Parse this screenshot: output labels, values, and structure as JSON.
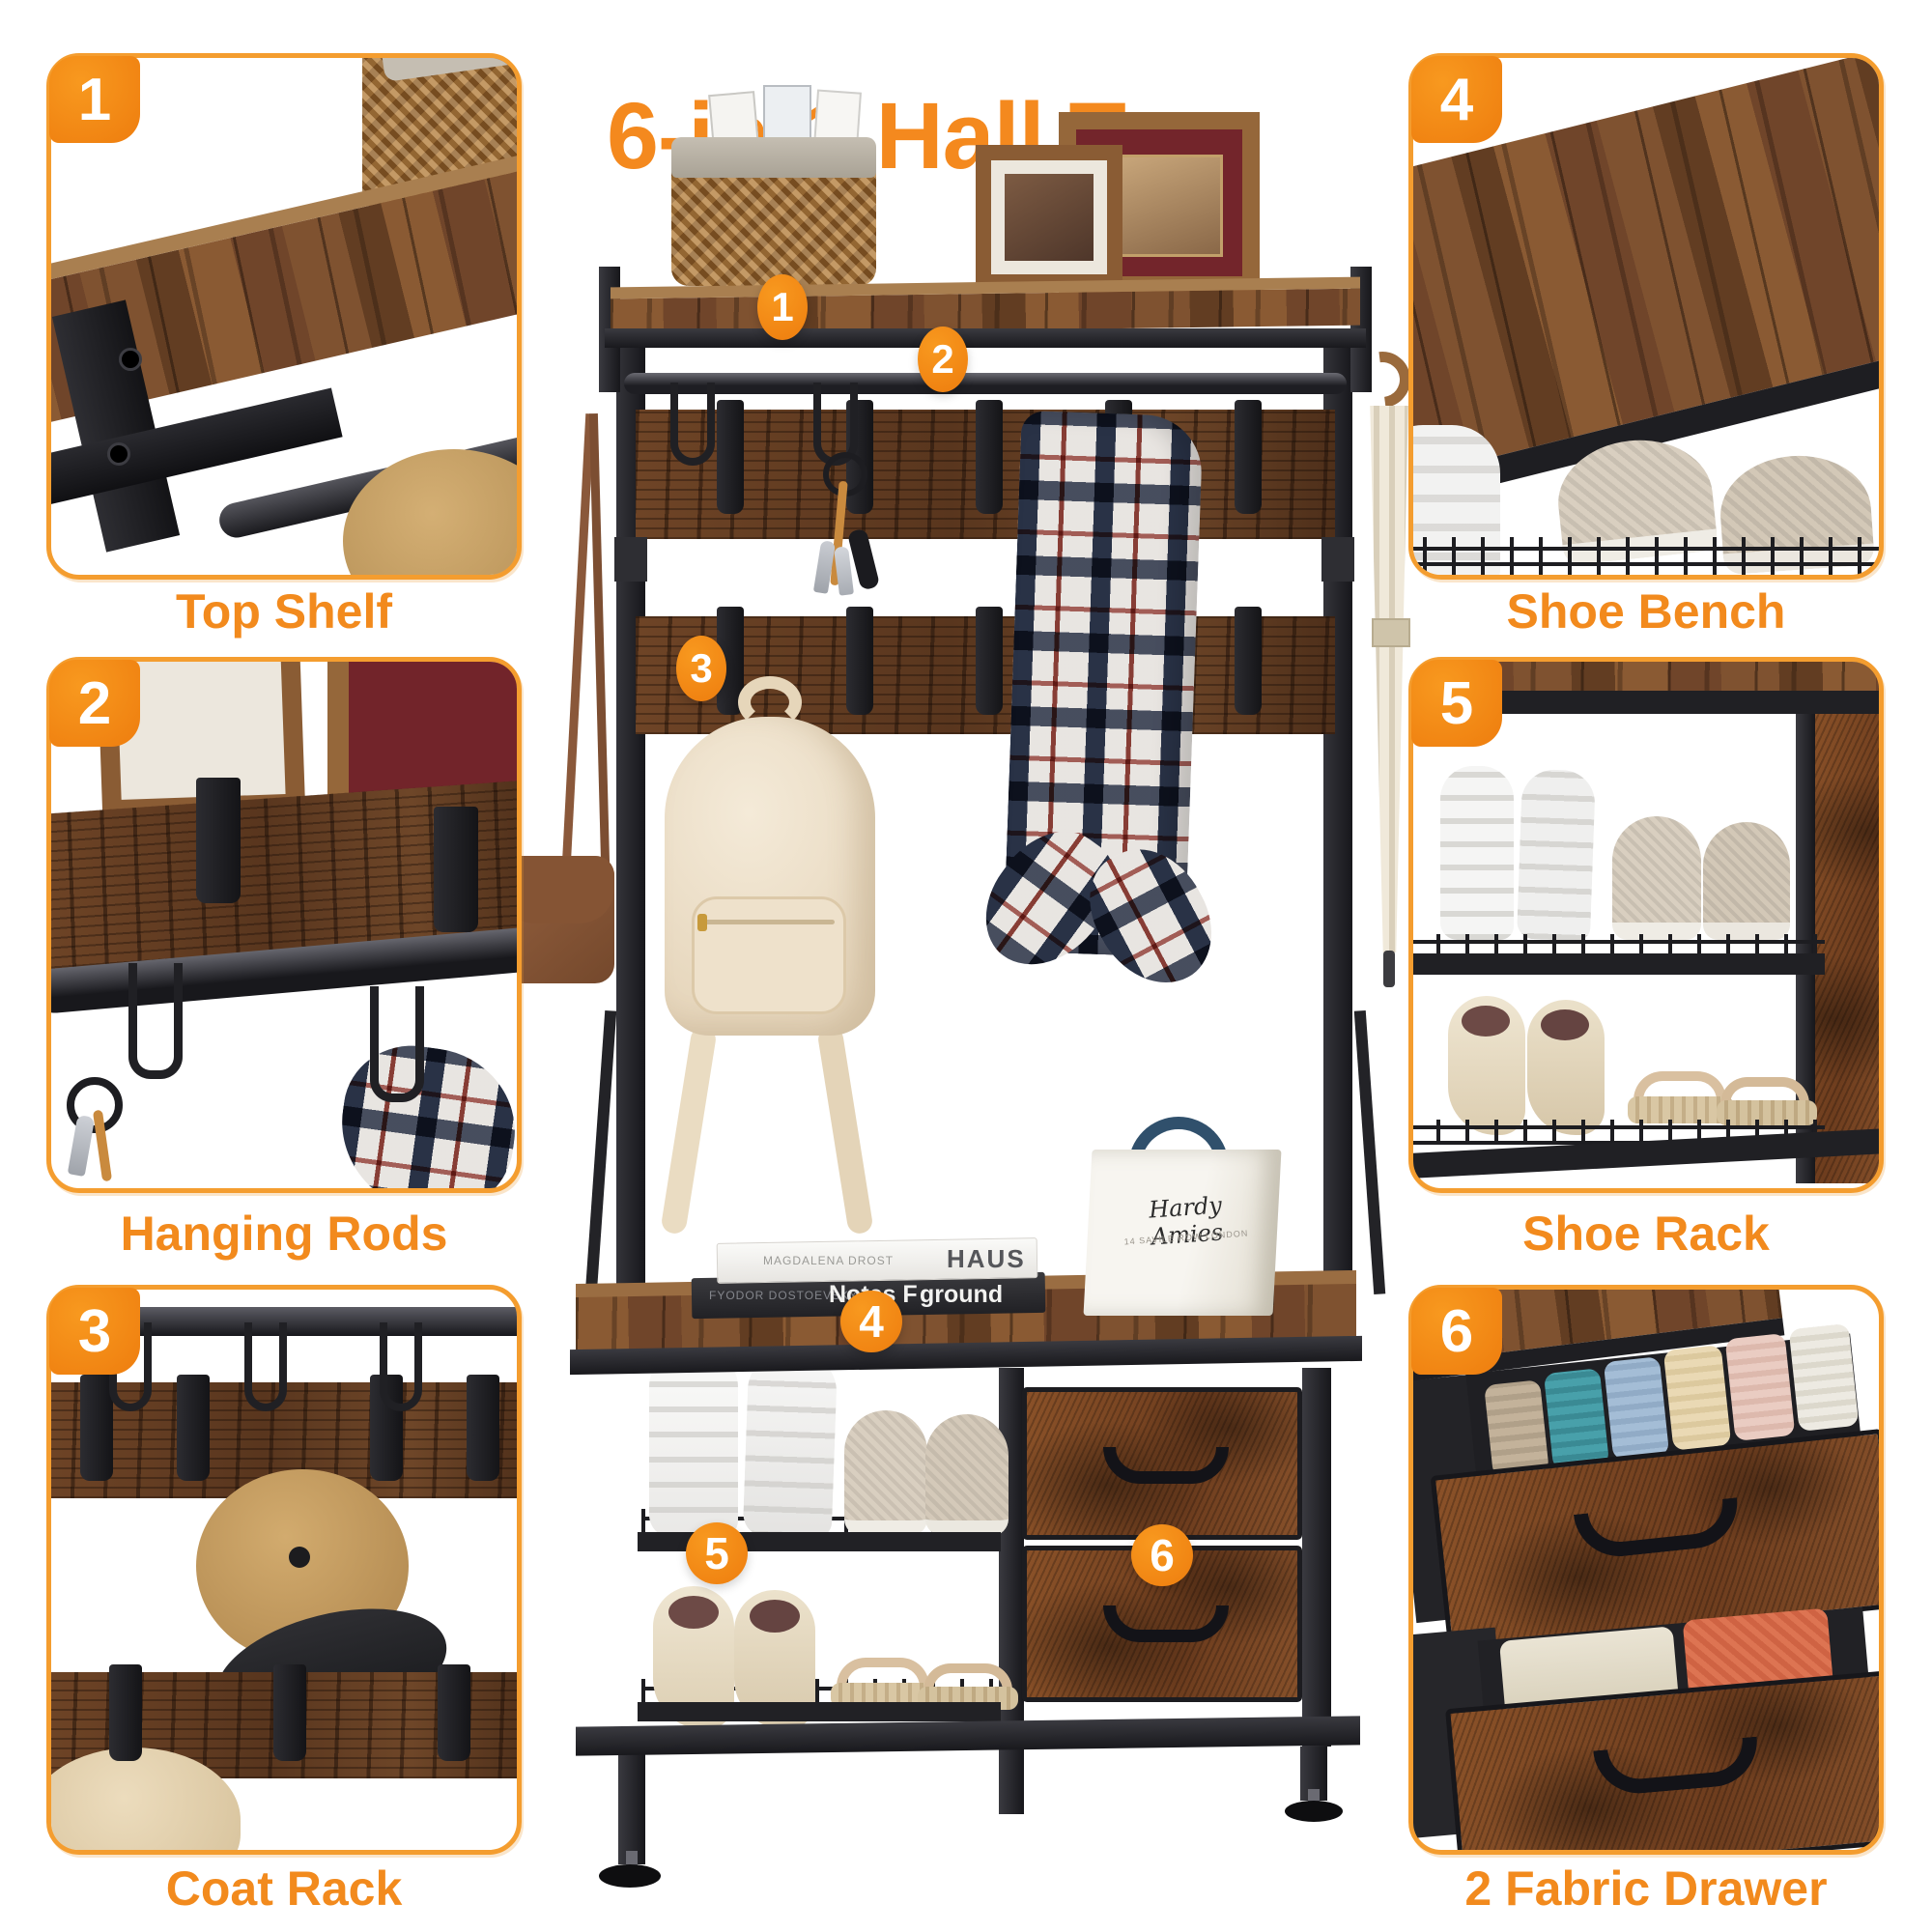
{
  "title": "6-in-1 Hall Tree",
  "colors": {
    "accent_orange": "#F4891E",
    "panel_border_orange": "#F49D2F",
    "badge_orange": "#F28118",
    "wood_brown": "#7A4A28",
    "metal_black": "#232327",
    "background": "#FFFFFF"
  },
  "panels": [
    {
      "number": "1",
      "label": "Top Shelf"
    },
    {
      "number": "2",
      "label": "Hanging Rods"
    },
    {
      "number": "3",
      "label": "Coat Rack"
    },
    {
      "number": "4",
      "label": "Shoe Bench"
    },
    {
      "number": "5",
      "label": "Shoe Rack"
    },
    {
      "number": "6",
      "label": "2 Fabric Drawer"
    }
  ],
  "callouts": [
    {
      "number": "1"
    },
    {
      "number": "2"
    },
    {
      "number": "3"
    },
    {
      "number": "4"
    },
    {
      "number": "5"
    },
    {
      "number": "6"
    }
  ],
  "decor_text": {
    "white_book_author": "MAGDALENA DROST",
    "white_book_title": "HAUS",
    "black_book_author": "FYODOR DOSTOEVSKY",
    "black_book_title_left": "Notes F",
    "black_book_title_right": "ground",
    "gift_bag_brand": "Hardy Amies",
    "gift_bag_caption": "14 SAVILE ROW LONDON"
  }
}
